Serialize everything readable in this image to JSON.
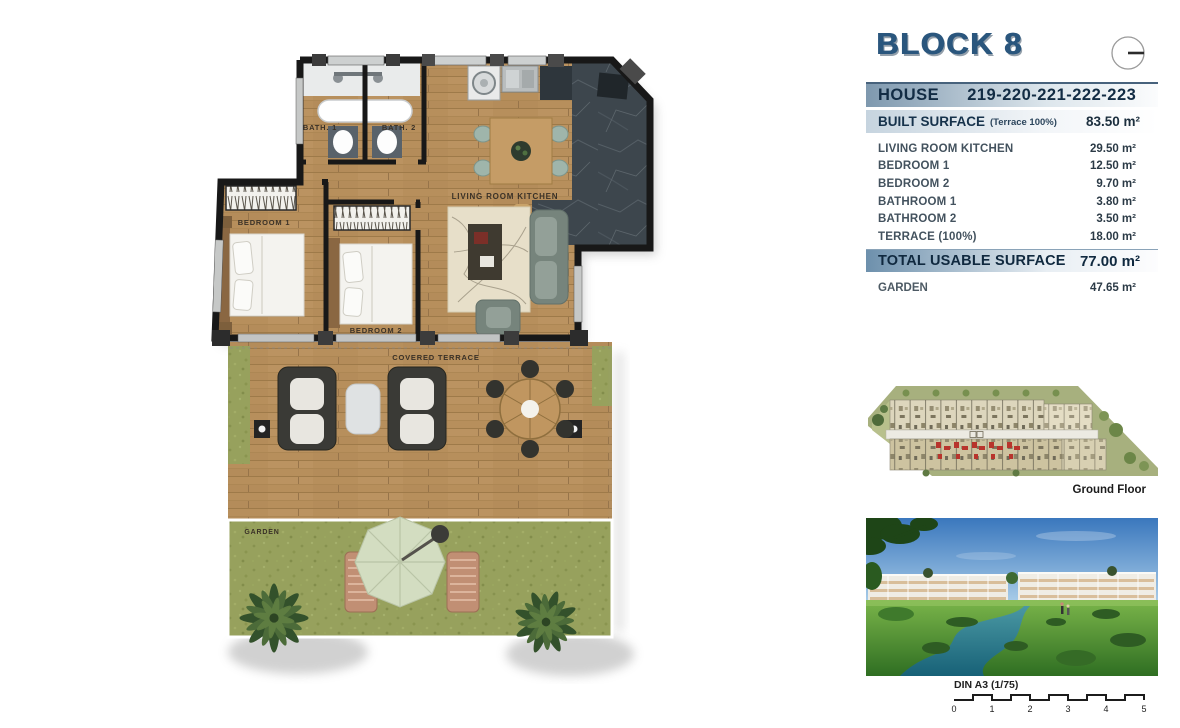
{
  "header": {
    "block_title": "BLOCK 8",
    "house_label": "HOUSE",
    "house_numbers": "219-220-221-222-223"
  },
  "summary": {
    "built_surface_label": "BUILT SURFACE",
    "built_surface_note": "(Terrace 100%)",
    "built_surface_value": "83.50 m²",
    "rows": [
      {
        "label": "LIVING ROOM KITCHEN",
        "value": "29.50 m²"
      },
      {
        "label": "BEDROOM 1",
        "value": "12.50 m²"
      },
      {
        "label": "BEDROOM 2",
        "value": "9.70 m²"
      },
      {
        "label": "BATHROOM 1",
        "value": "3.80 m²"
      },
      {
        "label": "BATHROOM 2",
        "value": "3.50 m²"
      },
      {
        "label": "TERRACE (100%)",
        "value": "18.00 m²"
      }
    ],
    "total_label": "TOTAL USABLE SURFACE",
    "total_value": "77.00 m²",
    "garden_label": "GARDEN",
    "garden_value": "47.65 m²"
  },
  "floorplan": {
    "labels": {
      "bath1": "BATH. 1",
      "bath2": "BATH. 2",
      "bedroom1": "BEDROOM 1",
      "bedroom2": "BEDROOM 2",
      "living": "LIVING ROOM KITCHEN",
      "terrace": "COVERED TERRACE",
      "garden": "GARDEN"
    }
  },
  "siteplan": {
    "caption": "Ground Floor"
  },
  "scalebar": {
    "label": "DIN A3 (1/75)",
    "ticks": [
      "0",
      "1",
      "2",
      "3",
      "4",
      "5"
    ]
  },
  "colors": {
    "accent_navy": "#13293f",
    "header_blue": "#2a567d",
    "bar_blue": "#7e98ae",
    "total_bar_blue": "#6d90ac",
    "highlight_red": "#c0392b",
    "wood": "#b78f5c",
    "grass": "#97a15d",
    "marble": "#3d464d",
    "sky_blue": "#3a77bd",
    "water_teal": "#2e7d86"
  }
}
